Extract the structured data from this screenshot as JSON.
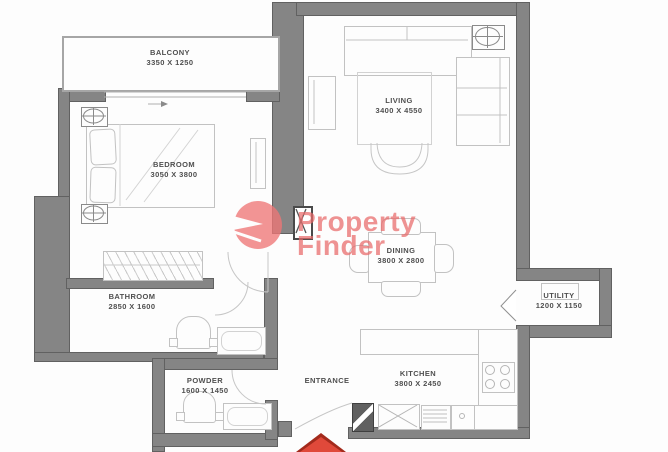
{
  "watermark": {
    "line1": "Property",
    "line2": "Finder"
  },
  "rooms": {
    "balcony": {
      "name": "BALCONY",
      "dims": "3350 X 1250"
    },
    "bedroom": {
      "name": "BEDROOM",
      "dims": "3050 X 3800"
    },
    "living": {
      "name": "LIVING",
      "dims": "3400 X 4550"
    },
    "dining": {
      "name": "DINING",
      "dims": "3800 X 2800"
    },
    "bathroom": {
      "name": "BATHROOM",
      "dims": "2850 X 1600"
    },
    "powder": {
      "name": "POWDER",
      "dims": "1600 X 1450"
    },
    "entrance": {
      "name": "ENTRANCE",
      "dims": ""
    },
    "kitchen": {
      "name": "KITCHEN",
      "dims": "3800 X 2450"
    },
    "utility": {
      "name": "UTILITY",
      "dims": "1200 X 1150"
    }
  },
  "colors": {
    "wall": "#858585",
    "watermark_pink": "#e96a6a",
    "entrance_arrow_red": "#dd4031",
    "furniture_stroke": "#c2c2c2",
    "label_text": "#4f4f4f"
  }
}
